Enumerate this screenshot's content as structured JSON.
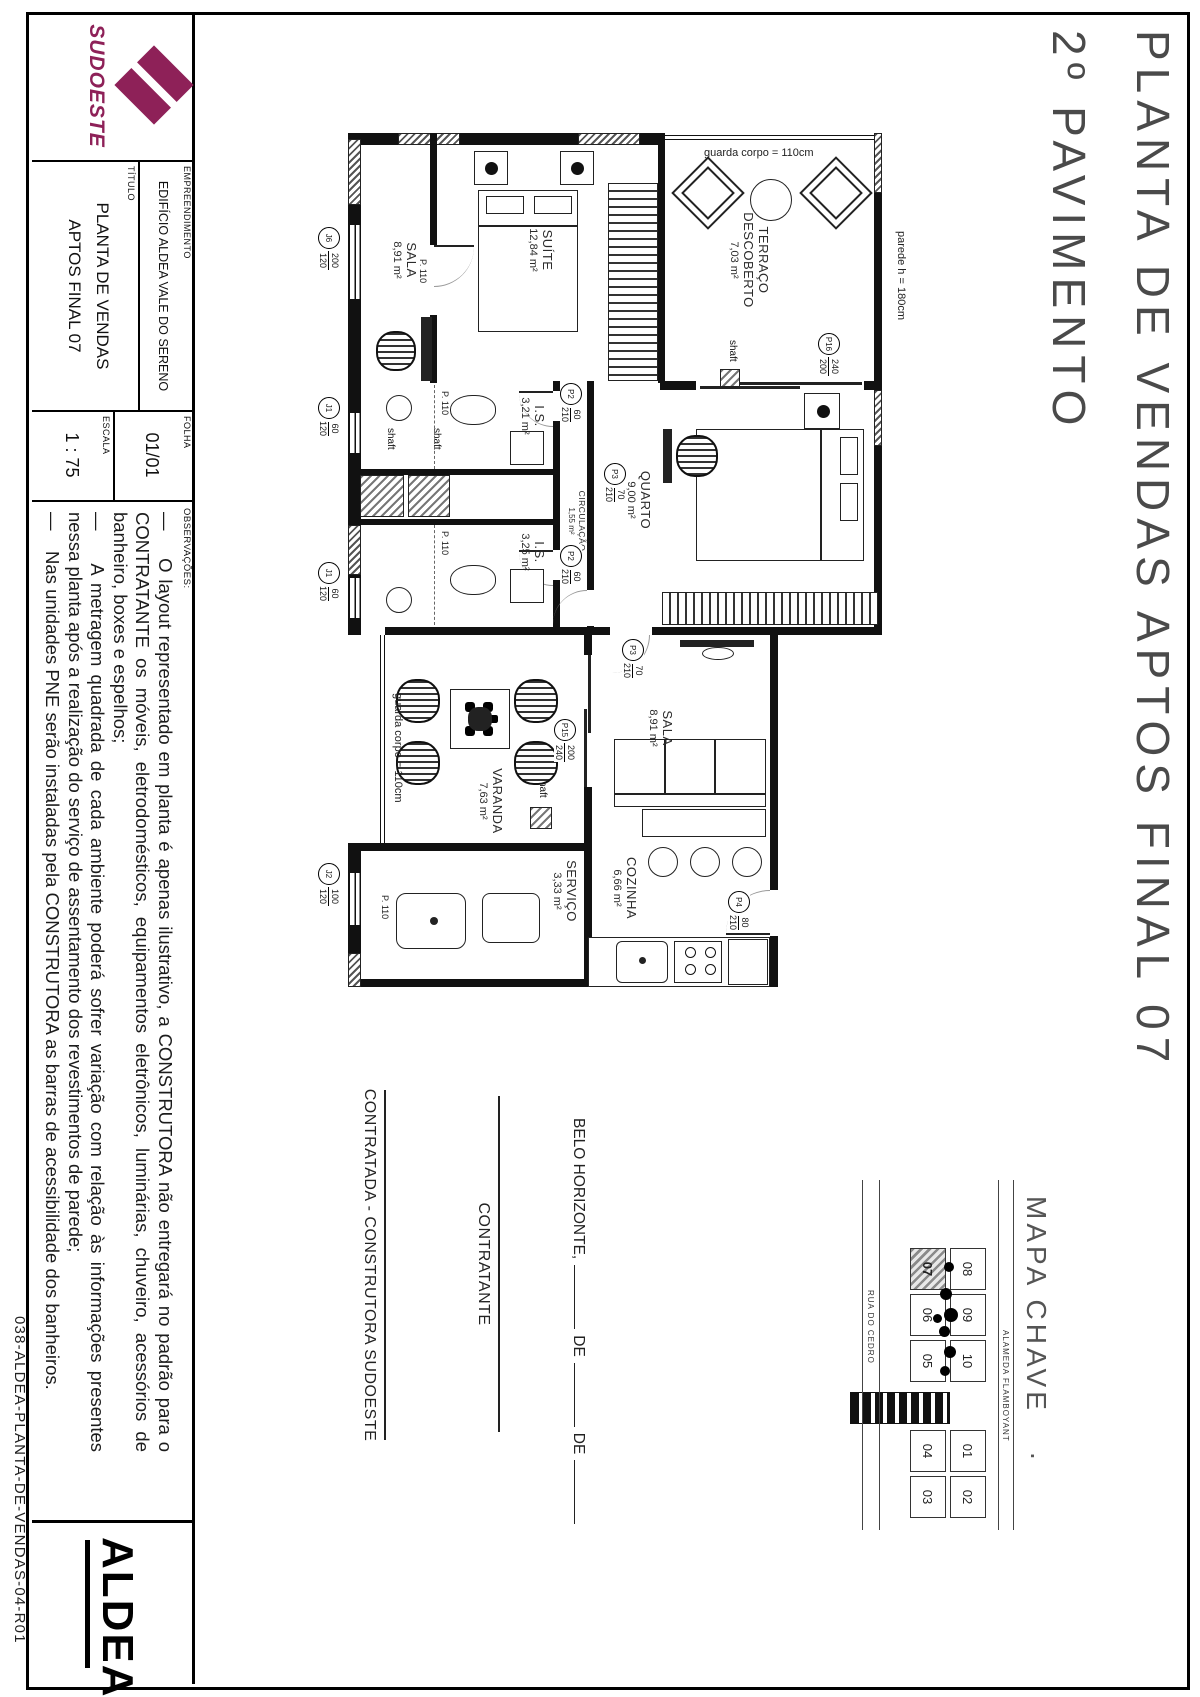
{
  "sheet": {
    "title_line1": "PLANTA DE VENDAS APTOS FINAL 07",
    "title_line2": "2º PAVIMENTO",
    "file_code": "038-ALDEA-PLANTA-DE-VENDAS-04-R01"
  },
  "title_block": {
    "logo_text": "SUDOESTE",
    "empreendimento_label": "EMPREENDIMENTO",
    "empreendimento_value": "EDIFÍCIO ALDEA VALE DO SERENO",
    "titulo_label": "TÍTULO",
    "titulo_line1": "PLANTA DE VENDAS",
    "titulo_line2": "APTOS FINAL 07",
    "folha_label": "FOLHA",
    "folha_value": "01/01",
    "escala_label": "ESCALA",
    "escala_value": "1 : 75",
    "observacoes_label": "OBSERVAÇÕES:",
    "observacoes": [
      "—    O layout representado em planta é apenas ilustrativo, a CONSTRUTORA não entregará no padrão para o CONTRATANTE os móveis, eletrodomésticos, equipamentos eletrônicos, luminárias, chuveiro, acessórios de banheiro, boxes e espelhos;",
      "—    A metragem quadrada de cada ambiente poderá sofrer variação com relação às informações presentes nessa planta após a realização do serviço de assentamento dos revestimentos de parede;",
      "—    Nas unidades PNE serão instaladas pela CONSTRUTORA as barras de acessibilidade dos banheiros."
    ],
    "aldea_logo": "ALDEA"
  },
  "signatures": {
    "city": "BELO HORIZONTE,",
    "de1": "DE",
    "de2": "DE",
    "contratante": "CONTRATANTE",
    "contratada": "CONTRATADA - CONSTRUTORA SUDOESTE"
  },
  "key_map": {
    "title": "MAPA CHAVE",
    "period": ".",
    "street_top": "ALAMEDA FLAMBOYANT",
    "street_bottom": "RUA DO CEDRO",
    "top_row": [
      "08",
      "09",
      "10",
      "01",
      "02"
    ],
    "bottom_row": [
      "07",
      "06",
      "05",
      "04",
      "03"
    ],
    "highlighted_unit": "07"
  },
  "plan": {
    "rooms": [
      {
        "name": "SALA",
        "area": "8,91 m²"
      },
      {
        "name": "SUÍTE",
        "area": "12,84 m²"
      },
      {
        "name": "TERRAÇO",
        "name2": "DESCOBERTO",
        "area": "7,03 m²"
      },
      {
        "name": "QUARTO",
        "area": "9,00 m²"
      },
      {
        "name": "I.S.",
        "area": "3,21 m²"
      },
      {
        "name": "I.S.",
        "area": "3,25 m²"
      },
      {
        "name": "CIRCULAÇÃO",
        "area": "1,55 m²"
      },
      {
        "name": "SALA",
        "area": "8,91 m²"
      },
      {
        "name": "VARANDA",
        "area": "7,63 m²"
      },
      {
        "name": "SERVIÇO",
        "area": "3,33 m²"
      },
      {
        "name": "COZINHA",
        "area": "6,66 m²"
      }
    ],
    "annotations": {
      "guard_terrace": "guarda corpo = 110cm",
      "guard_varanda": "guarda corpo = 110cm",
      "wall_height": "parede h = 180cm",
      "shaft": "shaft",
      "door_width": "P. 110"
    },
    "door_tags": [
      {
        "label": "P16",
        "top": "240",
        "bottom": "200"
      },
      {
        "label": "P15",
        "top": "200",
        "bottom": "240"
      },
      {
        "label": "P2",
        "top": "60",
        "bottom": "210"
      },
      {
        "label": "P2",
        "top": "60",
        "bottom": "210"
      },
      {
        "label": "P3",
        "top": "70",
        "bottom": "210"
      },
      {
        "label": "P3",
        "top": "70",
        "bottom": "210"
      },
      {
        "label": "P4",
        "top": "80",
        "bottom": "210"
      }
    ],
    "window_tags": [
      {
        "label": "J6",
        "top": "200",
        "bottom": "120"
      },
      {
        "label": "J1",
        "top": "60",
        "bottom": "120"
      },
      {
        "label": "J1",
        "top": "60",
        "bottom": "120"
      },
      {
        "label": "J2",
        "top": "100",
        "bottom": "120"
      }
    ]
  }
}
